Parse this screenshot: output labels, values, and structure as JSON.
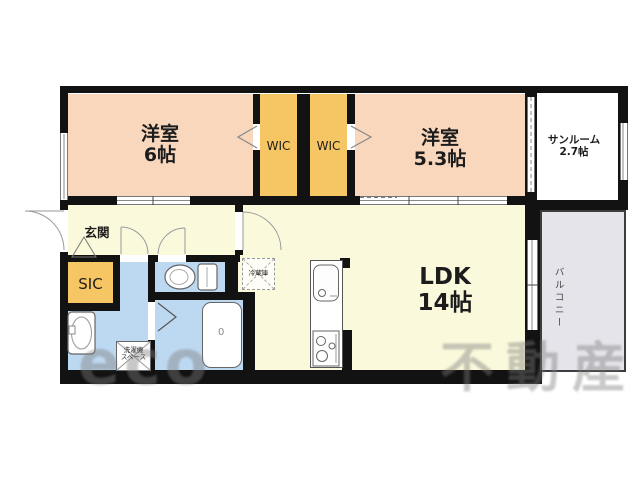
{
  "rooms": {
    "bedroom6": {
      "name": "洋室",
      "size": "6帖"
    },
    "wic1": "WIC",
    "wic2": "WIC",
    "bedroom53": {
      "name": "洋室",
      "size": "5.3帖"
    },
    "sunroom": {
      "name": "サンルーム",
      "size": "2.7帖"
    },
    "ldk": {
      "name": "LDK",
      "size": "14帖"
    },
    "entrance": "玄関",
    "sic": "SIC",
    "balcony": "バルコニー",
    "fridge": "冷蔵庫",
    "laundry": {
      "line1": "洗濯機",
      "line2": "スペース"
    },
    "bath_drain": "0"
  },
  "watermark": {
    "logo": "eco",
    "text": "不動産"
  },
  "colors": {
    "room_peach": "#f8d7bd",
    "closet_orange": "#f6c664",
    "floor_cream": "#fbf9dc",
    "wet_blue": "#bdd8f1",
    "balcony_gray": "#e4e4ea",
    "sunroom_white": "#ffffff",
    "wall_black": "#121212"
  }
}
